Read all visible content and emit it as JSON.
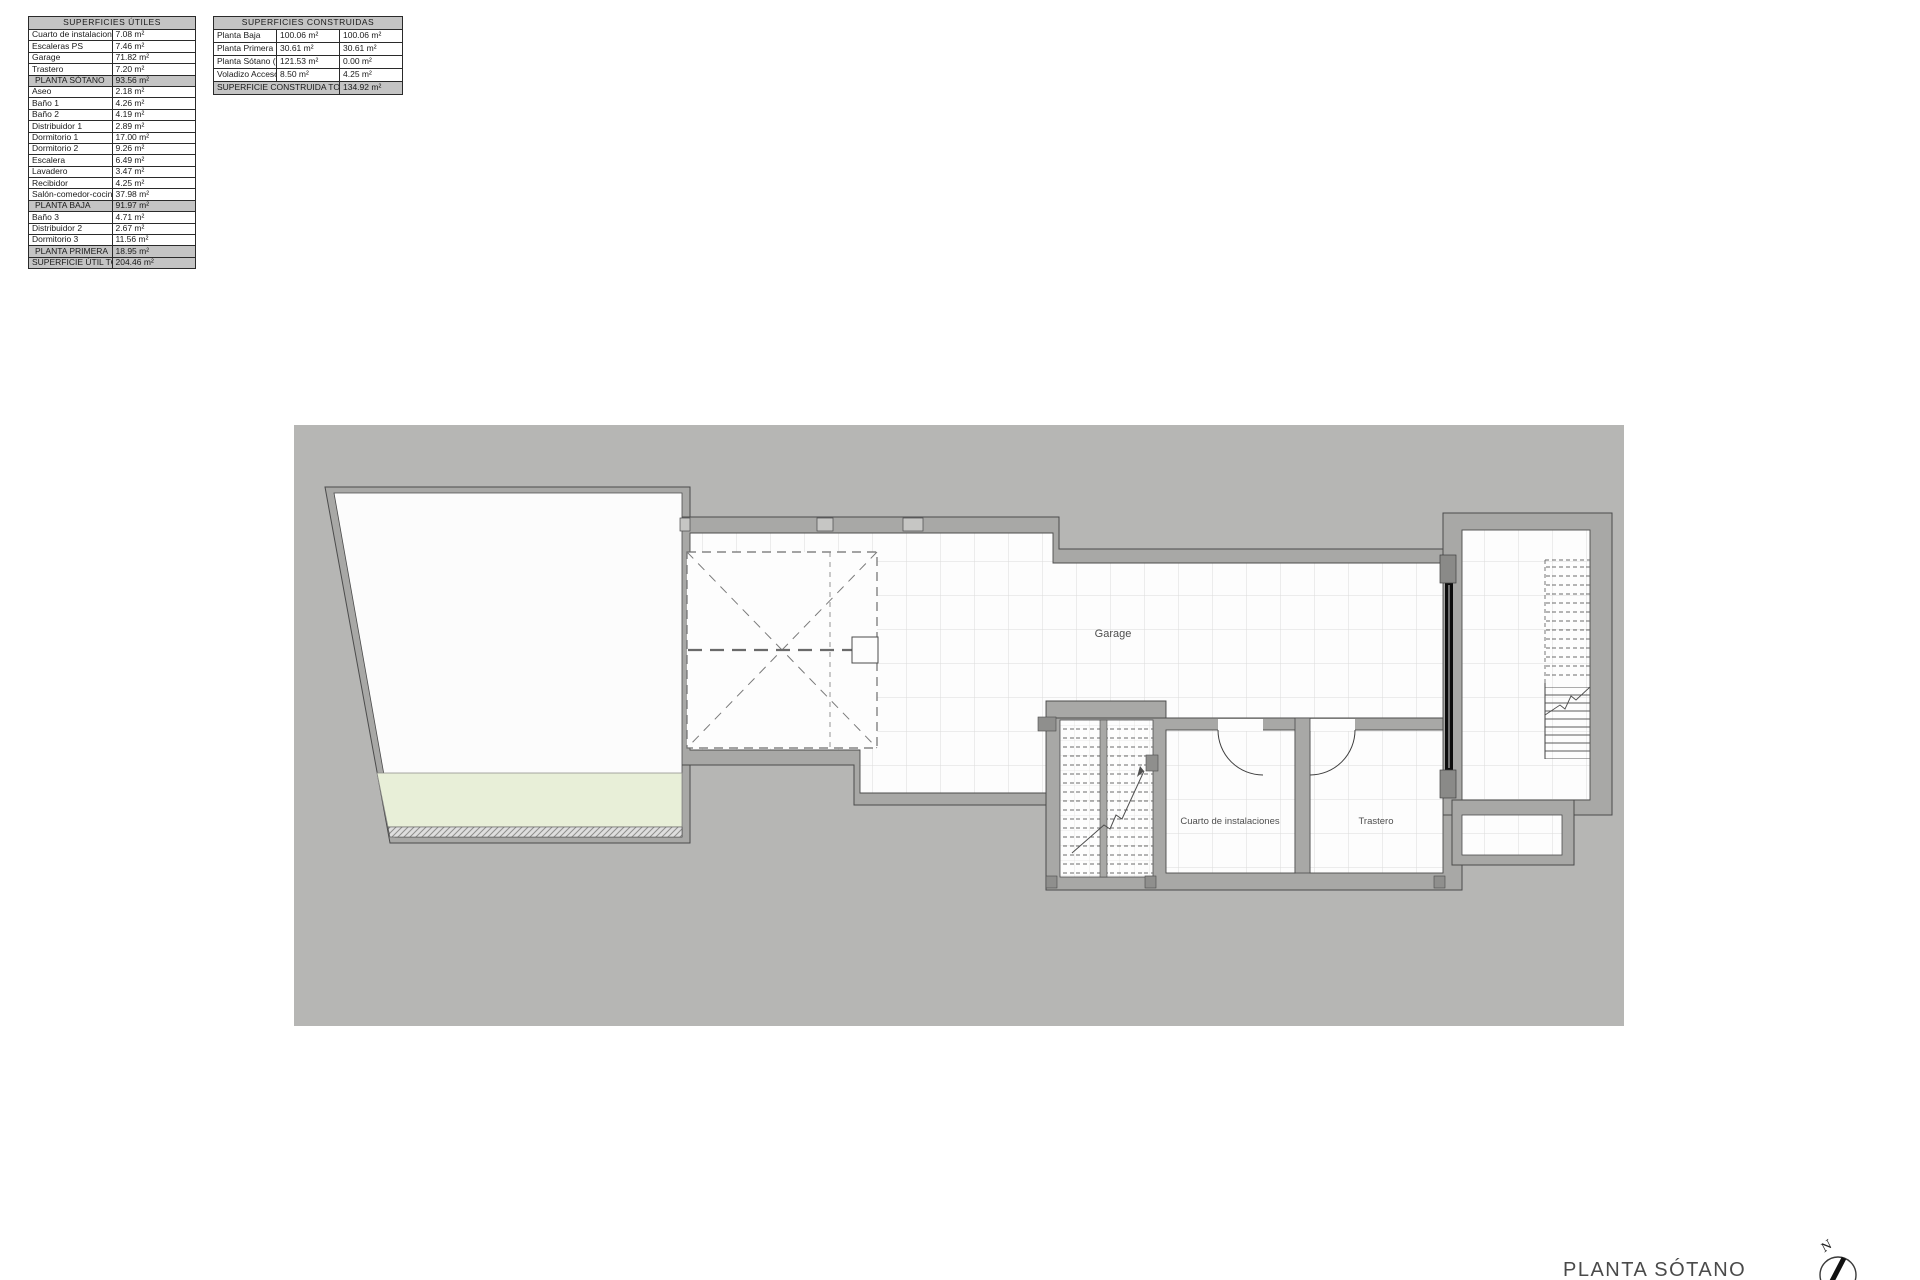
{
  "colors": {
    "canvas_gray": "#b6b6b4",
    "wall_gray": "#a8a8a6",
    "outline": "#4b4b4b",
    "terrace_green": "#e8efd8",
    "table_header_gray": "#c4c4c4",
    "door_black": "#0d0d0d"
  },
  "tables": {
    "utiles": {
      "title": "SUPERFICIES ÚTILES",
      "rows": [
        {
          "label": "Cuarto de instalaciones",
          "value": "7.08 m²"
        },
        {
          "label": "Escaleras PS",
          "value": "7.46 m²"
        },
        {
          "label": "Garage",
          "value": "71.82 m²"
        },
        {
          "label": "Trastero",
          "value": "7.20 m²"
        },
        {
          "label": "PLANTA SÓTANO",
          "value": "93.56 m²",
          "type": "section"
        },
        {
          "label": "Aseo",
          "value": "2.18 m²"
        },
        {
          "label": "Baño 1",
          "value": "4.26 m²"
        },
        {
          "label": "Baño 2",
          "value": "4.19 m²"
        },
        {
          "label": "Distribuidor 1",
          "value": "2.89 m²"
        },
        {
          "label": "Dormitorio 1",
          "value": "17.00 m²"
        },
        {
          "label": "Dormitorio 2",
          "value": "9.26 m²"
        },
        {
          "label": "Escalera",
          "value": "6.49 m²"
        },
        {
          "label": "Lavadero",
          "value": "3.47 m²"
        },
        {
          "label": "Recibidor",
          "value": "4.25 m²"
        },
        {
          "label": "Salón-comedor-cocina",
          "value": "37.98 m²"
        },
        {
          "label": "PLANTA BAJA",
          "value": "91.97 m²",
          "type": "section"
        },
        {
          "label": "Baño 3",
          "value": "4.71 m²"
        },
        {
          "label": "Distribuidor 2",
          "value": "2.67 m²"
        },
        {
          "label": "Dormitorio 3",
          "value": "11.56 m²"
        },
        {
          "label": "PLANTA PRIMERA",
          "value": "18.95 m²",
          "type": "section"
        },
        {
          "label": "SUPERFICIE ÚTIL TOTAL",
          "value": "204.46 m²",
          "type": "total"
        }
      ]
    },
    "construidas": {
      "title": "SUPERFICIES CONSTRUIDAS",
      "rows": [
        {
          "label": "Planta Baja",
          "v1": "100.06 m²",
          "v2": "100.06 m²"
        },
        {
          "label": "Planta Primera",
          "v1": "30.61 m²",
          "v2": "30.61 m²"
        },
        {
          "label": "Planta Sótano (0%)",
          "v1": "121.53 m²",
          "v2": "0.00 m²"
        },
        {
          "label": "Voladizo Acceso(50%)",
          "v1": "8.50 m²",
          "v2": "4.25 m²"
        },
        {
          "label": "SUPERFICIE CONSTRUIDA TOTAL",
          "v2": "134.92 m²",
          "span": 2,
          "type": "total"
        }
      ]
    }
  },
  "plan": {
    "room_labels": {
      "garage": "Garage",
      "cuarto": "Cuarto de instalaciones",
      "trastero": "Trastero"
    },
    "caption": "PLANTA SÓTANO",
    "north_letter": "N"
  }
}
